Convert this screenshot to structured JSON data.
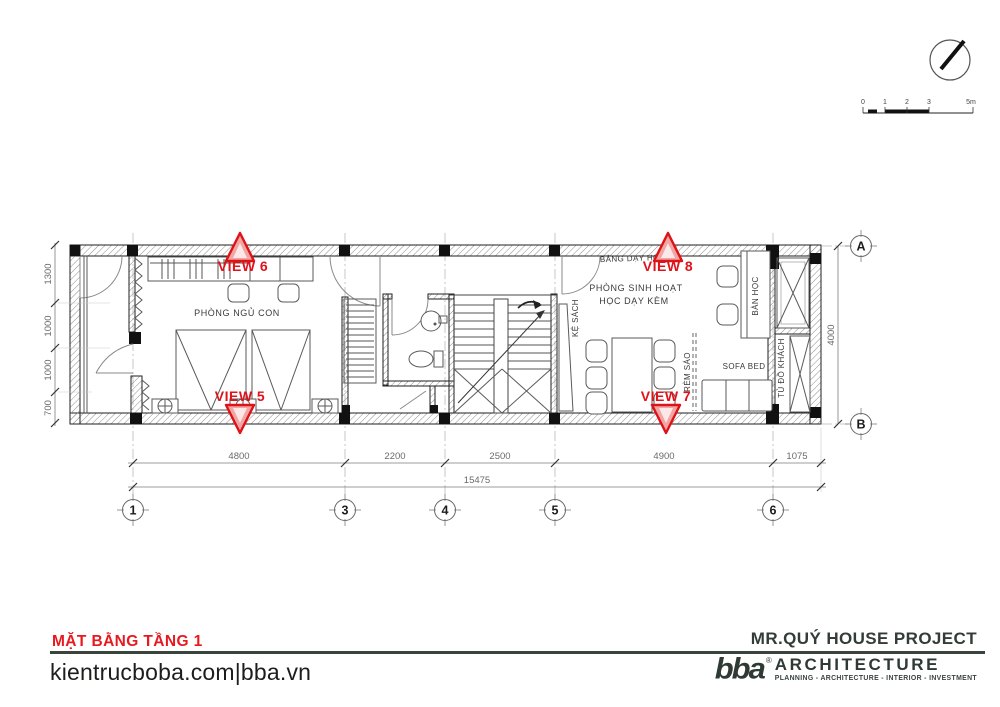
{
  "plan": {
    "rooms": {
      "bedroom": "PHÒNG NGỦ CON",
      "teaching_board": "BẢNG DẠY HỌC",
      "living_room_line1": "PHÒNG SINH HOẠT",
      "living_room_line2": "HỌC DẠY KÈM",
      "bookshelf": "KỆ SÁCH",
      "study_desk": "BÀN HỌC",
      "sofa_bed": "SOFA BED",
      "blinds": "RÈM SÁO",
      "guest_wardrobe": "TỦ ĐỒ KHÁCH"
    },
    "views": {
      "v5": "VIEW 5",
      "v6": "VIEW 6",
      "v7": "VIEW 7",
      "v8": "VIEW 8"
    }
  },
  "dimensions": {
    "bottom": [
      "4800",
      "2200",
      "2500",
      "4900",
      "1075"
    ],
    "total_bottom": "15475",
    "left": [
      "1300",
      "1000",
      "1000",
      "700"
    ],
    "right_total": "4000"
  },
  "grid": {
    "cols": [
      "1",
      "3",
      "4",
      "5",
      "6"
    ],
    "rows": [
      "A",
      "B"
    ]
  },
  "scale_bar": {
    "labels": [
      "0",
      "1",
      "2",
      "3",
      "5m"
    ]
  },
  "footer": {
    "plan_title": "MẶT BẰNG TẦNG 1",
    "website": "kientrucboba.com|bba.vn",
    "project_title": "MR.QUÝ HOUSE PROJECT",
    "logo_text": "bba",
    "logo_reg": "®",
    "logo_brand": "ARCHITECTURE",
    "logo_tagline": "PLANNING - ARCHITECTURE - INTERIOR - INVESTMENT"
  },
  "colors": {
    "accent_red": "#e8141b",
    "brand_dark": "#333e38"
  }
}
